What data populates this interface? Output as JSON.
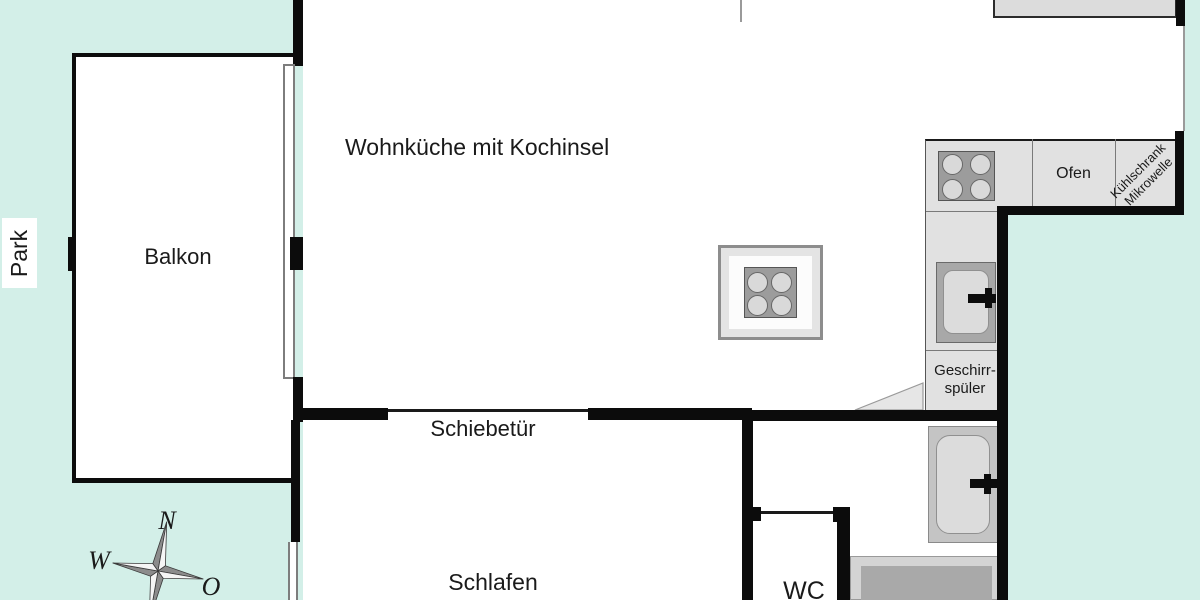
{
  "plan": {
    "rooms": {
      "living_kitchen": "Wohnküche mit Kochinsel",
      "balcony": "Balkon",
      "bedroom": "Schlafen",
      "wc": "WC"
    },
    "outdoor": {
      "park": "Park"
    },
    "doors": {
      "sliding_door": "Schiebetür"
    },
    "appliances": {
      "oven": "Ofen",
      "fridge_line1": "Kühlschrank",
      "fridge_line2": "Mikrowelle",
      "dishwasher_line1": "Geschirr-",
      "dishwasher_line2": "spüler"
    },
    "compass": {
      "north": "N",
      "west": "W",
      "east": "O"
    },
    "colors": {
      "park_background": "#d3efe8",
      "wall": "#0c0c0c",
      "counter": "#e1e1e1",
      "appliance_dark": "#9c9c9c",
      "fixture_light": "#dcdcdc"
    }
  }
}
